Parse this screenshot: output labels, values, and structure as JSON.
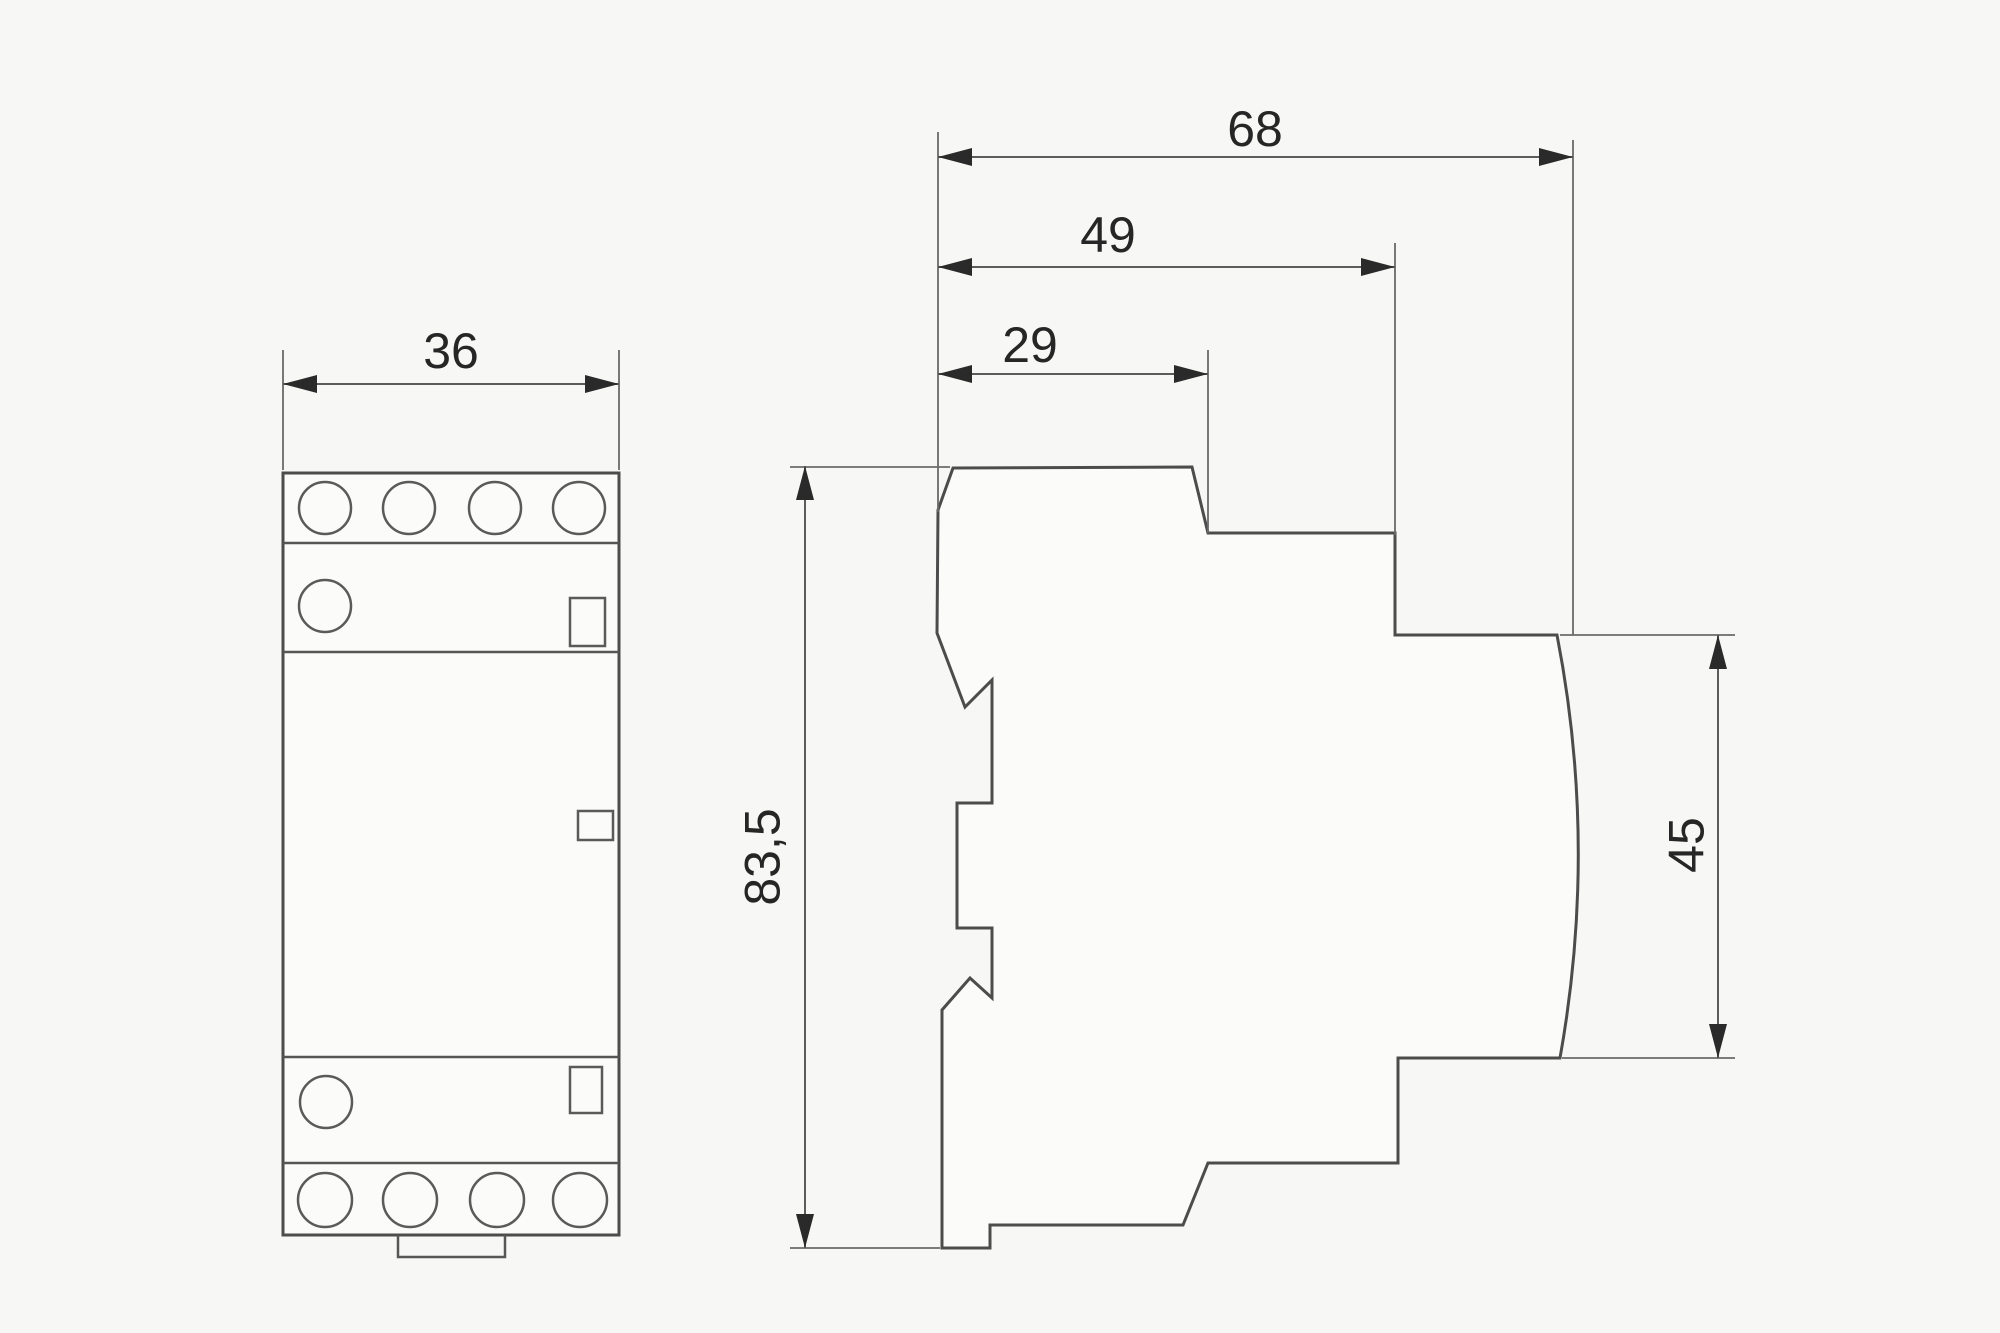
{
  "dimensions": {
    "front_width": {
      "label": "36"
    },
    "overall_depth": {
      "label": "68"
    },
    "upper_depth": {
      "label": "49"
    },
    "top_depth": {
      "label": "29"
    },
    "overall_height": {
      "label": "83,5"
    },
    "front_height": {
      "label": "45"
    }
  }
}
